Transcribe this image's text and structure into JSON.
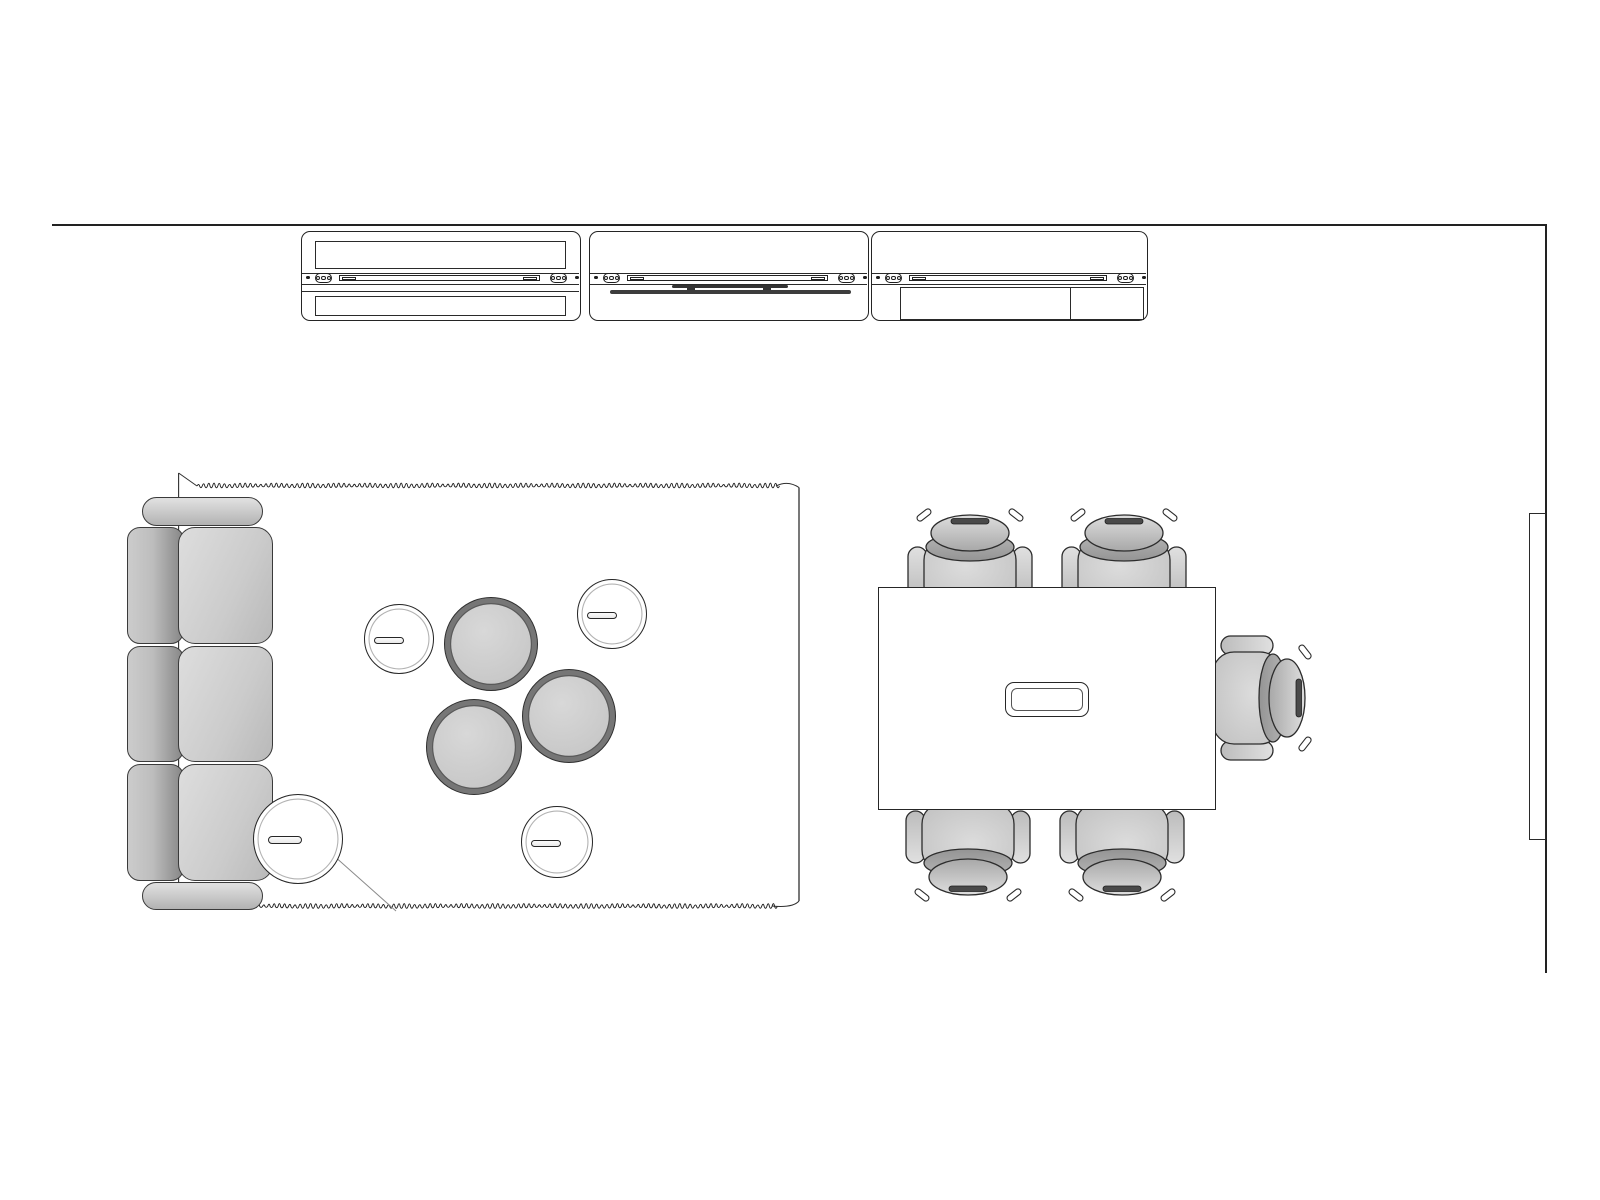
{
  "document": {
    "title": "Meeting space floor plan line drawing",
    "background": "#ffffff",
    "canvas": {
      "width": 1600,
      "height": 1200
    }
  },
  "colors": {
    "outline": "#262626",
    "furniture_light": "#d8d8d8",
    "furniture_mid": "#c3c3c3",
    "furniture_dark": "#8a8a8a",
    "ottoman_ring": "#767676",
    "media_bar": "#3d3d3d",
    "rug_slit": "#8a8a8a"
  },
  "walls": {
    "top": {
      "x1": 52,
      "y": 224,
      "x2": 1547
    },
    "right": {
      "x": 1545,
      "y1": 224,
      "y2": 973
    },
    "panel": {
      "x": 1529,
      "y": 513,
      "w": 17,
      "h": 327
    }
  },
  "storage_wall": {
    "y": 231,
    "h": 90,
    "units": [
      {
        "x": 301,
        "w": 280,
        "top_shelf": true,
        "bottom_shelf": true,
        "shelf_line": true,
        "media": false,
        "bottom_rect": false
      },
      {
        "x": 589,
        "w": 280,
        "top_shelf": false,
        "bottom_shelf": false,
        "shelf_line": false,
        "media": true,
        "bottom_rect": false
      },
      {
        "x": 871,
        "w": 277,
        "top_shelf": false,
        "bottom_shelf": false,
        "shelf_line": false,
        "media": false,
        "bottom_rect": true
      }
    ],
    "rail": {
      "top_y": 271.5,
      "bottom_y": 283.2,
      "shelf_line_y": 290.2
    },
    "media": {
      "bracket": {
        "x1": 671,
        "x2": 787,
        "y": 284.2,
        "h": 2.6
      },
      "mounts": [
        {
          "x": 686
        },
        {
          "x": 762
        }
      ],
      "screen": {
        "x1": 609,
        "x2": 850,
        "y": 288.6,
        "h": 4.8
      }
    },
    "bottom_rect": {
      "x1": 899,
      "x2": 1143,
      "y1": 285.5,
      "y2": 318.5,
      "divider_x": 1068
    }
  },
  "rug": {
    "x": 178,
    "y": 470,
    "w": 624,
    "h": 445,
    "left_edge": {
      "x": 178,
      "y1": 473,
      "y2": 907.5
    },
    "right_edge": {
      "x": 799,
      "y1": 487.5,
      "y2": 901
    },
    "fringe_top": {
      "x1": 197,
      "x2": 776,
      "y": 486
    },
    "fringe_bottom": {
      "x1": 200,
      "x2": 772,
      "y": 906
    },
    "slit": {
      "x1": 333,
      "y1": 855,
      "x2": 396,
      "y2": 911
    }
  },
  "sofa": {
    "x": 127,
    "y": 497,
    "arm_top": {
      "x": 142,
      "y": 497,
      "w": 121,
      "h": 29
    },
    "arm_bottom": {
      "x": 142,
      "y": 882,
      "w": 121,
      "h": 28
    },
    "back_x": 127,
    "back_w": 57,
    "seat_x": 178,
    "seat_w": 95,
    "rows": [
      {
        "y": 527,
        "h": 117
      },
      {
        "y": 646,
        "h": 116
      },
      {
        "y": 764,
        "h": 117
      }
    ]
  },
  "side_tables": [
    {
      "cx": 399,
      "cy": 639,
      "r": 35,
      "slot_w": 30,
      "slot_h": 7,
      "slot_dx": -11
    },
    {
      "cx": 612,
      "cy": 614,
      "r": 35,
      "slot_w": 30,
      "slot_h": 7,
      "slot_dx": -11
    },
    {
      "cx": 557,
      "cy": 842,
      "r": 36,
      "slot_w": 30,
      "slot_h": 7,
      "slot_dx": -12
    },
    {
      "cx": 298,
      "cy": 839,
      "r": 45,
      "slot_w": 34,
      "slot_h": 8,
      "slot_dx": -14
    }
  ],
  "ottomans": [
    {
      "cx": 491,
      "cy": 644,
      "r": 47
    },
    {
      "cx": 569,
      "cy": 716,
      "r": 47
    },
    {
      "cx": 474,
      "cy": 747,
      "r": 48
    }
  ],
  "conference": {
    "table": {
      "x": 878,
      "y": 587,
      "w": 338,
      "h": 223
    },
    "grommet": {
      "x": 1004,
      "y": 681,
      "w": 84,
      "h": 35,
      "inset": 4.5
    },
    "chairs": [
      {
        "cx": 970,
        "cy": 557,
        "rot": 0
      },
      {
        "cx": 1124,
        "cy": 557,
        "rot": 0
      },
      {
        "cx": 968,
        "cy": 853,
        "rot": 180
      },
      {
        "cx": 1122,
        "cy": 853,
        "rot": 180
      },
      {
        "cx": 1263,
        "cy": 698,
        "rot": 90
      }
    ]
  }
}
